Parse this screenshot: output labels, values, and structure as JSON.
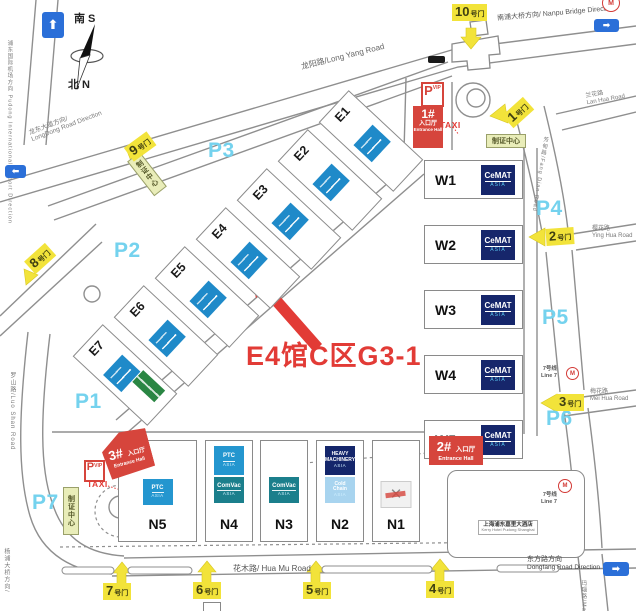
{
  "annotation": {
    "booth_label": "E4馆C区G3-1"
  },
  "compass": {
    "south": "南 S",
    "north": "北 N"
  },
  "parking": {
    "p1": "P1",
    "p2": "P2",
    "p3": "P3",
    "p4": "P4",
    "p5": "P5",
    "p6": "P6",
    "p7": "P7"
  },
  "gates": {
    "g1": {
      "num": "1",
      "suffix": "号门"
    },
    "g2": {
      "num": "2",
      "suffix": "号门"
    },
    "g3": {
      "num": "3",
      "suffix": "号门"
    },
    "g4": {
      "num": "4",
      "suffix": "号门"
    },
    "g5": {
      "num": "5",
      "suffix": "号门"
    },
    "g6": {
      "num": "6",
      "suffix": "号门"
    },
    "g7": {
      "num": "7",
      "suffix": "号门"
    },
    "g8": {
      "num": "8",
      "suffix": "号门"
    },
    "g9": {
      "num": "9",
      "suffix": "号门"
    },
    "g10": {
      "num": "10",
      "suffix": "号门"
    }
  },
  "entrances": {
    "e1": {
      "num": "1#",
      "label": "入口厅",
      "label_en": "Entrance Hall"
    },
    "e2": {
      "num": "2#",
      "label": "入口厅",
      "label_en": "Entrance Hall"
    },
    "e3": {
      "num": "3#",
      "label": "入口厅",
      "label_en": "Entrance Hall"
    }
  },
  "halls": {
    "east": [
      {
        "id": "E1"
      },
      {
        "id": "E2"
      },
      {
        "id": "E3"
      },
      {
        "id": "E4"
      },
      {
        "id": "E5"
      },
      {
        "id": "E6"
      },
      {
        "id": "E7"
      }
    ],
    "west": [
      {
        "id": "W1"
      },
      {
        "id": "W2"
      },
      {
        "id": "W3"
      },
      {
        "id": "W4"
      },
      {
        "id": "W5"
      }
    ],
    "north": [
      {
        "id": "N5"
      },
      {
        "id": "N4"
      },
      {
        "id": "N3"
      },
      {
        "id": "N2"
      },
      {
        "id": "N1"
      }
    ]
  },
  "logos": {
    "cemat": {
      "main": "CeMAT",
      "sub": "ASIA"
    },
    "ptc": {
      "main": "PTC",
      "sub": "ASIA"
    },
    "comvac": {
      "main": "ComVac",
      "sub": "ASIA"
    },
    "heavy": {
      "line1": "HEAVY",
      "line2": "MACHINERY",
      "sub": "ASIA"
    },
    "cold": {
      "line1": "Cold",
      "line2": "Chain",
      "sub": "ASIA"
    }
  },
  "roads": {
    "long_yang": "龙阳路/Long Yang Road",
    "long_dong_zh": "龙东大道方向/",
    "long_dong_en": "LongDong Road Direction",
    "nanpu": "南浦大桥方向/ Nanpu Bridge Direction",
    "lan_hua_zh": "兰花路",
    "lan_hua_en": "Lan Hua Road",
    "ying_hua_zh": "樱花路",
    "ying_hua_en": "Ying Hua Road",
    "mei_hua_zh": "梅花路",
    "mei_hua_en": "Mei Hua Road",
    "hua_mu": "花木路/ Hua Mu Road",
    "dongfang_zh": "东方路方向",
    "dongfang_en": "Dongfang Road Direction",
    "fang_dian": "芳甸路/Fang Dian Road",
    "luo_shan": "罗山路/Luo Shan Road",
    "pudong_airport": "浦东国际机场方向 Pudong International Airport Direction",
    "yangpu_bridge": "杨浦大桥方向/",
    "ma_nao": "玛瑙路/Ma Nao Road"
  },
  "transit": {
    "line7_zh": "7号线",
    "line7_en": "Line 7"
  },
  "places": {
    "cert_center": "制证中心",
    "taxi": "TAXI",
    "p_vip_p": "P",
    "p_vip_sub": "VIP",
    "kerry_zh": "上海浦东嘉里大酒店",
    "kerry_en": "Kerry Hotel Pudong Shanghai"
  },
  "colors": {
    "entrance_red": "#d6453c",
    "annotation_red": "#e23b36",
    "gate_yellow": "#f2e33a",
    "parking_blue": "#74d2ee",
    "cemat_navy": "#16266b",
    "expo_blue": "#1f8ac9",
    "comvac_teal": "#1b7f8c",
    "cold_lightblue": "#a8d4ef",
    "green_logo": "#2a8643",
    "road_gray": "#8f8f8f",
    "direction_blue": "#2b6fd8"
  }
}
